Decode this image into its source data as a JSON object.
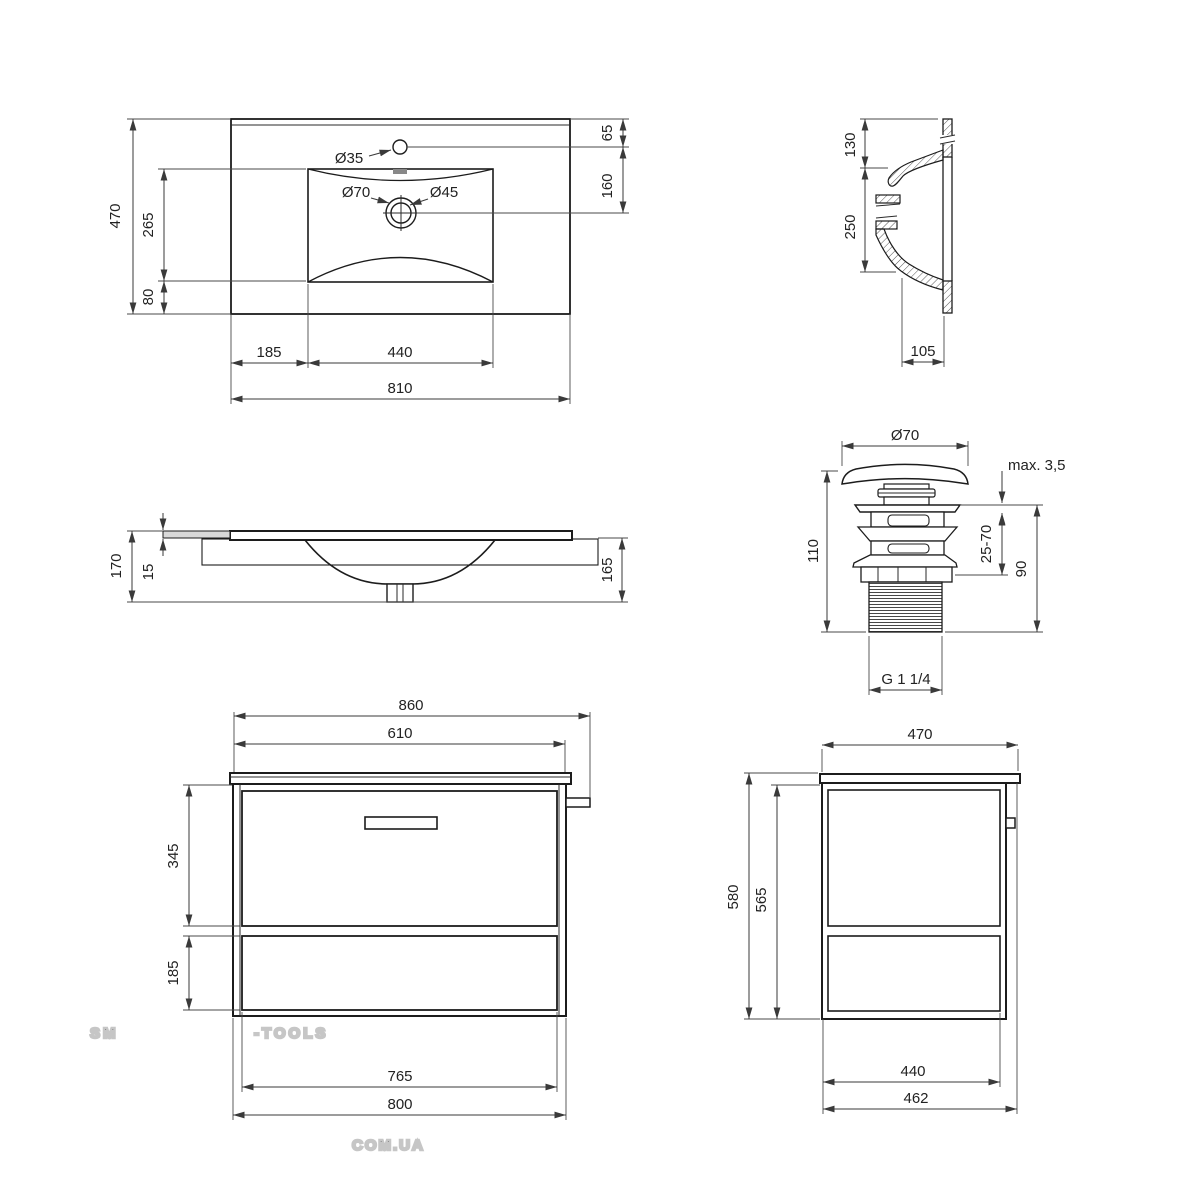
{
  "watermark": {
    "brand_accent": "SM",
    "brand_rest": "-TOOLS",
    "domain": "COM.UA"
  },
  "colors": {
    "line": "#1c1c1c",
    "dimension": "#3a3a3a",
    "watermark_accent_fill": "#f8dcc2",
    "watermark_stroke": "#c6c6c6",
    "hatch": "#555555",
    "panel_fill": "#d9d9d9"
  },
  "basin_top": {
    "overall_width": "810",
    "overall_depth": "470",
    "bowl_width": "440",
    "bowl_offset_left": "185",
    "bowl_depth": "265",
    "bowl_offset_front": "80",
    "faucet_offset": "65",
    "faucet_to_drain": "160",
    "faucet_hole": "Ø35",
    "drain_outer": "Ø70",
    "drain_inner": "Ø45"
  },
  "basin_section": {
    "rim_height": "130",
    "bowl_height": "250",
    "base_depth": "105"
  },
  "basin_front": {
    "total_height": "170",
    "deck_thickness": "15",
    "body_height": "165"
  },
  "valve": {
    "cap_diameter": "Ø70",
    "plate_max": "max. 3,5",
    "total_height": "110",
    "clamp_range": "25-70",
    "body_height": "90",
    "thread": "G 1 1/4"
  },
  "cabinet_front": {
    "overall_width": "860",
    "hanger_width": "610",
    "top_drawer_height": "345",
    "bottom_drawer_height": "185",
    "drawer_width": "765",
    "body_width": "800"
  },
  "cabinet_side": {
    "top_depth": "470",
    "total_height": "580",
    "body_height": "565",
    "drawer_depth": "440",
    "body_depth": "462"
  }
}
